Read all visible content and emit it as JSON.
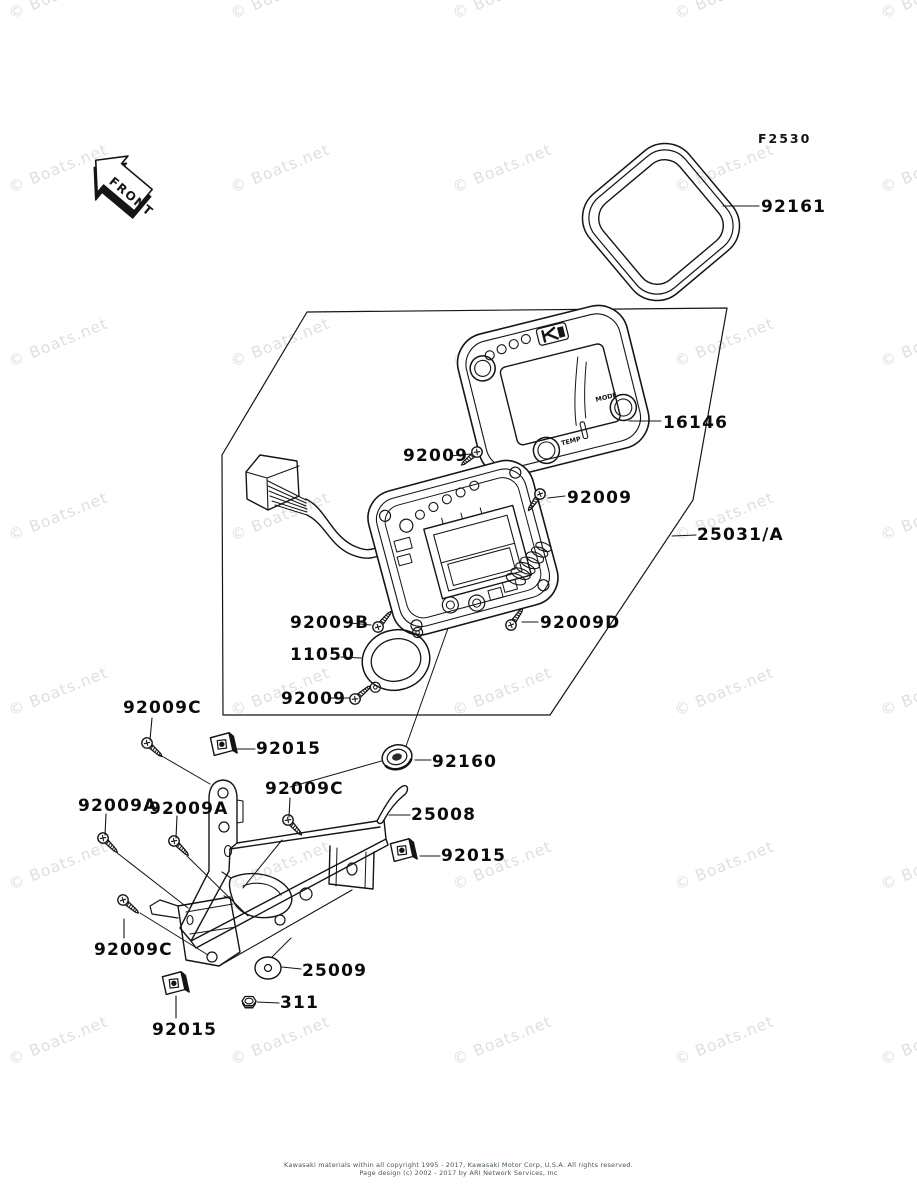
{
  "diagram": {
    "code": "F2530",
    "front_label": "FRONT",
    "watermark": "© Boats.net",
    "copyright_line1": "Kawasaki materials within all copyright 1995 - 2017, Kawasaki Motor Corp, U.S.A.  All rights reserved.",
    "copyright_line2": "Page design (c) 2002 - 2017 by ARI Network Services, Inc"
  },
  "meter": {
    "logo": "K",
    "temp_label": "TEMP",
    "mode_label": "MODE"
  },
  "labels": [
    {
      "part": "92161",
      "text": "92161"
    },
    {
      "part": "16146",
      "text": "16146"
    },
    {
      "part": "92009",
      "text": "92009"
    },
    {
      "part": "92009",
      "text": "92009"
    },
    {
      "part": "25031/A",
      "text": "25031/A"
    },
    {
      "part": "92009B",
      "text": "92009B"
    },
    {
      "part": "92009D",
      "text": "92009D"
    },
    {
      "part": "11050",
      "text": "11050"
    },
    {
      "part": "92009",
      "text": "92009"
    },
    {
      "part": "92009C",
      "text": "92009C"
    },
    {
      "part": "92015",
      "text": "92015"
    },
    {
      "part": "92160",
      "text": "92160"
    },
    {
      "part": "92009C",
      "text": "92009C"
    },
    {
      "part": "25008",
      "text": "25008"
    },
    {
      "part": "92009A",
      "text": "92009A"
    },
    {
      "part": "92009A",
      "text": "92009A"
    },
    {
      "part": "92015",
      "text": "92015"
    },
    {
      "part": "92009C",
      "text": "92009C"
    },
    {
      "part": "25009",
      "text": "25009"
    },
    {
      "part": "311",
      "text": "311"
    },
    {
      "part": "92015",
      "text": "92015"
    }
  ],
  "colors": {
    "line": "#151515",
    "watermark": "#dbe0e3",
    "copyright": "#49584f"
  }
}
